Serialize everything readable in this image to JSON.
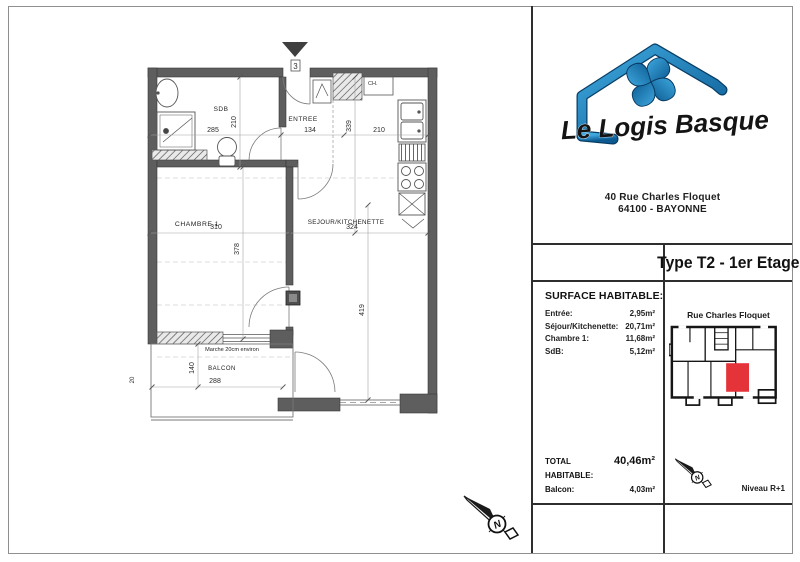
{
  "page": {
    "background": "#ffffff"
  },
  "plan": {
    "unit_number": "3",
    "compass_letter": "N",
    "labels": {
      "sdb": "SDB",
      "entree": "ENTREE",
      "chambre": "CHAMBRE 1",
      "sejour": "SEJOUR/KITCHENETTE",
      "balcon": "BALCON",
      "marche": "Marche 20cm environ",
      "water_heater": "CH."
    },
    "dims": {
      "sdb_width": "285",
      "sdb_depth": "210",
      "entree_width": "134",
      "kitchen_depth": "339",
      "kitchen_width": "210",
      "chambre_width": "310",
      "chambre_depth": "378",
      "sejour_width": "324",
      "sejour_depth": "419",
      "balcon_width": "288",
      "balcon_depth": "140",
      "balcon_edge": "20"
    }
  },
  "panel": {
    "logo_name": "Le Logis Basque",
    "address_line1": "40 Rue Charles Floquet",
    "address_line2": "64100 - BAYONNE",
    "type_title": "Type T2 - 1er Etage",
    "surface": {
      "heading": "SURFACE HABITABLE:",
      "rows": [
        {
          "label": "Entrée:",
          "value": "2,95m²"
        },
        {
          "label": "Séjour/Kitchenette:",
          "value": "20,71m²"
        },
        {
          "label": "Chambre 1:",
          "value": "11,68m²"
        },
        {
          "label": "SdB:",
          "value": "5,12m²"
        }
      ],
      "total_label": "TOTAL HABITABLE:",
      "total_value": "40,46m²",
      "balcony_label": "Balcon:",
      "balcony_value": "4,03m²"
    },
    "keyplan_caption": "Rue Charles Floquet",
    "level_label": "Niveau R+1",
    "colors": {
      "logo_blue": "#1b87c9",
      "highlight_red": "#e5333a"
    }
  }
}
